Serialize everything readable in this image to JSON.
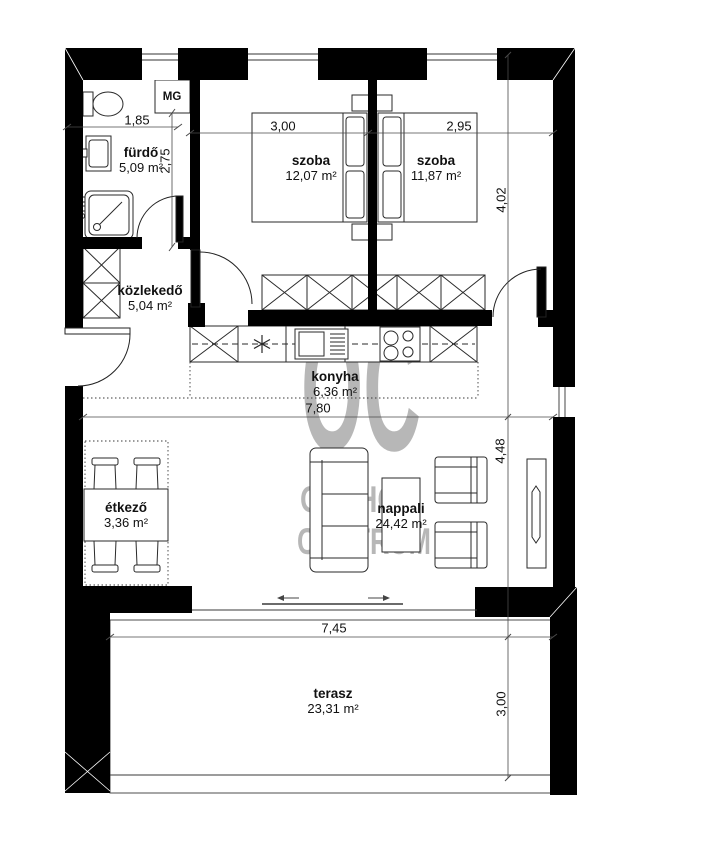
{
  "document": {
    "type": "floor-plan",
    "language": "hu"
  },
  "watermark": {
    "monogram": "OC",
    "name_line1": "OTTHON",
    "name_line2": "CENTRUM",
    "color": "#b7b7b7"
  },
  "rooms": [
    {
      "name": "fürdő",
      "area": "5,09 m²"
    },
    {
      "name": "közlekedő",
      "area": "5,04 m²"
    },
    {
      "name": "szoba",
      "area": "12,07 m²"
    },
    {
      "name": "szoba",
      "area": "11,87 m²"
    },
    {
      "name": "konyha",
      "area": "6,36 m²"
    },
    {
      "name": "étkező",
      "area": "3,36 m²"
    },
    {
      "name": "nappali",
      "area": "24,42 m²"
    },
    {
      "name": "terasz",
      "area": "23,31 m²"
    }
  ],
  "dimensions_m": [
    {
      "label": "1,85"
    },
    {
      "label": "2,75"
    },
    {
      "label": "3,00"
    },
    {
      "label": "2,95"
    },
    {
      "label": "4,02"
    },
    {
      "label": "7,80"
    },
    {
      "label": "4,48"
    },
    {
      "label": "7,45"
    },
    {
      "label": "3,00"
    }
  ],
  "labels": {
    "utility_shaft": "MG"
  },
  "colors": {
    "wall": "#000000",
    "line": "#3a3a3a",
    "watermark": "#b7b7b7",
    "background": "#ffffff"
  }
}
